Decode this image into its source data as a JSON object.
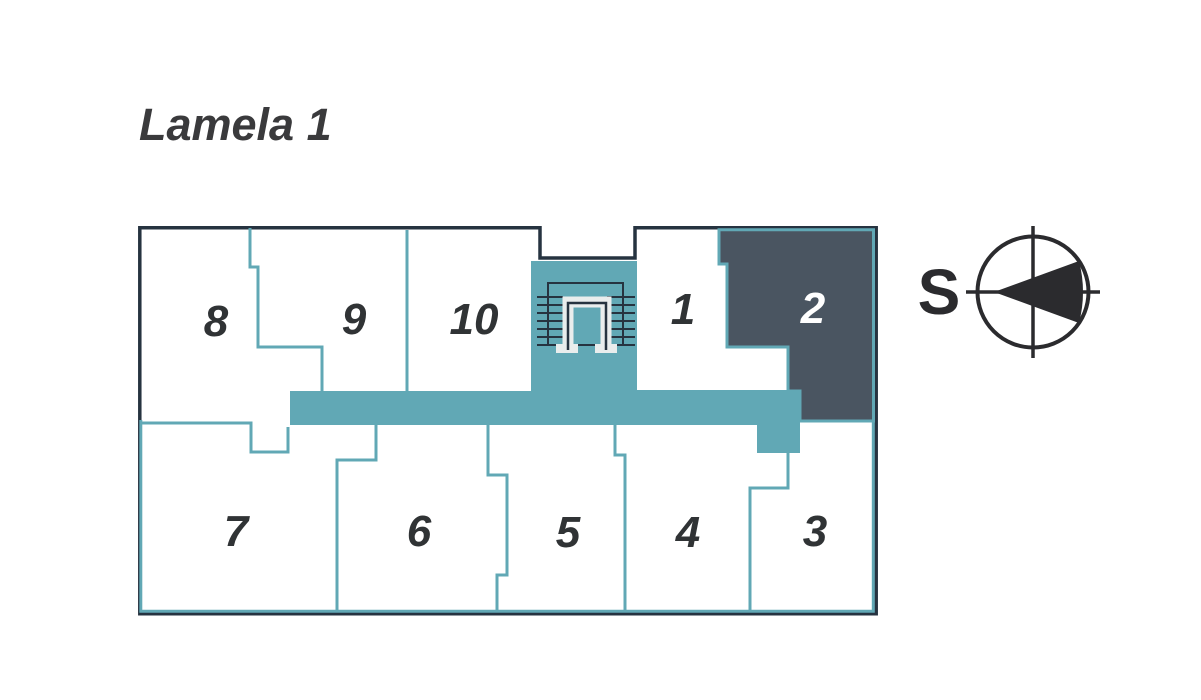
{
  "title": "Lamela 1",
  "plan": {
    "name": "floor-plan-lamela-1",
    "units": [
      {
        "number": "8",
        "highlighted": false
      },
      {
        "number": "9",
        "highlighted": false
      },
      {
        "number": "10",
        "highlighted": false
      },
      {
        "number": "1",
        "highlighted": false
      },
      {
        "number": "2",
        "highlighted": true
      },
      {
        "number": "7",
        "highlighted": false
      },
      {
        "number": "6",
        "highlighted": false
      },
      {
        "number": "5",
        "highlighted": false
      },
      {
        "number": "4",
        "highlighted": false
      },
      {
        "number": "3",
        "highlighted": false
      }
    ],
    "highlighted_unit": "2"
  },
  "compass": {
    "direction_label": "S"
  },
  "colors": {
    "corridor_teal": "#61a8b5",
    "highlight_fill": "#4a5561",
    "outline_dark": "#263340",
    "unit_label": "#303335",
    "highlight_label": "#ffffff",
    "title_color": "#3a3a3c",
    "compass_color": "#2b2b2e",
    "stair_door_white": "#e9eded"
  }
}
